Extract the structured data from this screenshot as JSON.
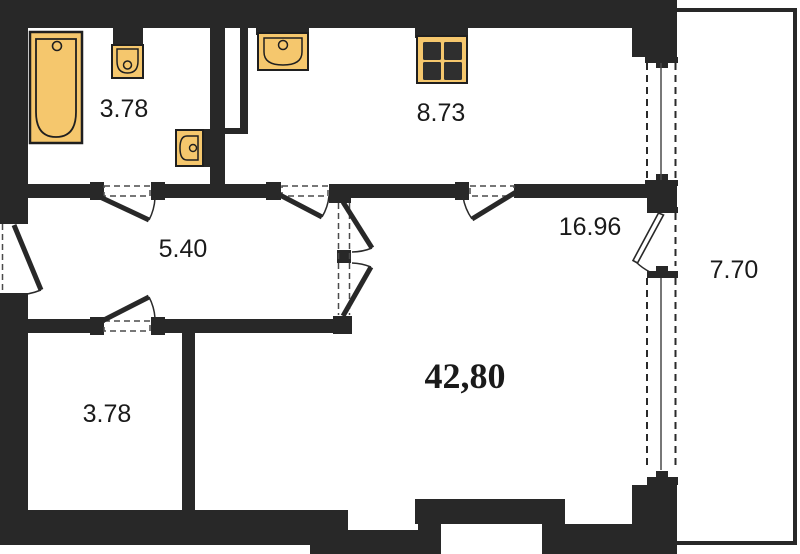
{
  "plan": {
    "type": "apartment-floor-plan",
    "total_area": "42,80",
    "rooms": [
      {
        "id": "bathroom",
        "area": "3.78"
      },
      {
        "id": "kitchen",
        "area": "8.73"
      },
      {
        "id": "hallway",
        "area": "5.40"
      },
      {
        "id": "living-room",
        "area": "16.96"
      },
      {
        "id": "balcony",
        "area": "7.70"
      },
      {
        "id": "storeroom",
        "area": "3.78"
      }
    ],
    "fixtures": [
      "bathtub",
      "toilet",
      "hand-sink",
      "kitchen-sink",
      "stove"
    ],
    "colors": {
      "wall": "#282828",
      "fixture_fill": "#f5c76d",
      "fixture_stroke": "#1f1f1f",
      "background": "#ffffff",
      "label": "#1a1a1a"
    }
  },
  "labels": {
    "bathroom": "3.78",
    "kitchen": "8.73",
    "hallway": "5.40",
    "living": "16.96",
    "balcony": "7.70",
    "storeroom": "3.78",
    "total": "42,80"
  }
}
